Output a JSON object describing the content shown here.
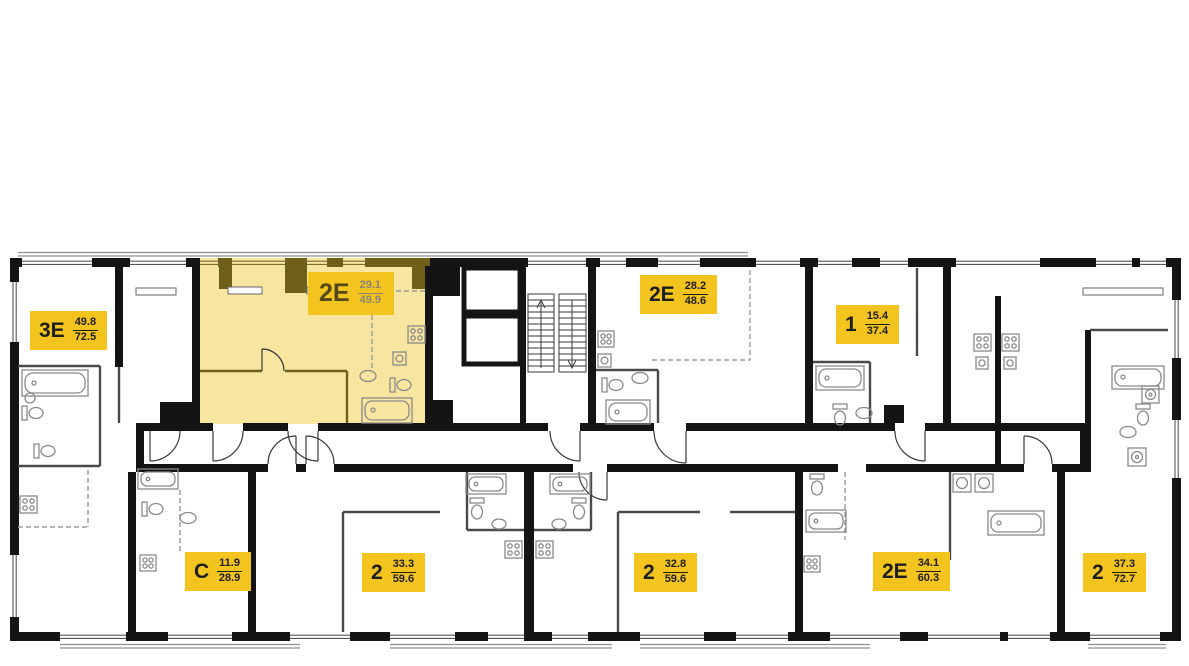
{
  "floorplan": {
    "apartments": [
      {
        "type": "3Е",
        "living_area": "49.8",
        "total_area": "72.5",
        "selected": false
      },
      {
        "type": "2Е",
        "living_area": "29.1",
        "total_area": "49.9",
        "selected": true
      },
      {
        "type": "2Е",
        "living_area": "28.2",
        "total_area": "48.6",
        "selected": false
      },
      {
        "type": "1",
        "living_area": "15.4",
        "total_area": "37.4",
        "selected": false
      },
      {
        "type": "С",
        "living_area": "11.9",
        "total_area": "28.9",
        "selected": false
      },
      {
        "type": "2",
        "living_area": "33.3",
        "total_area": "59.6",
        "selected": false
      },
      {
        "type": "2",
        "living_area": "32.8",
        "total_area": "59.6",
        "selected": false
      },
      {
        "type": "2Е",
        "living_area": "34.1",
        "total_area": "60.3",
        "selected": false
      },
      {
        "type": "2",
        "living_area": "37.3",
        "total_area": "72.7",
        "selected": false
      }
    ],
    "colors": {
      "wall": "#141414",
      "highlight_fill": "#f8e5a0",
      "highlight_wall": "#6f6019",
      "label_bg": "#f3c41e",
      "label_text": "#1e1e1e",
      "hl_label_text": "#55491b",
      "hl_label_area": "#8b8472"
    }
  }
}
